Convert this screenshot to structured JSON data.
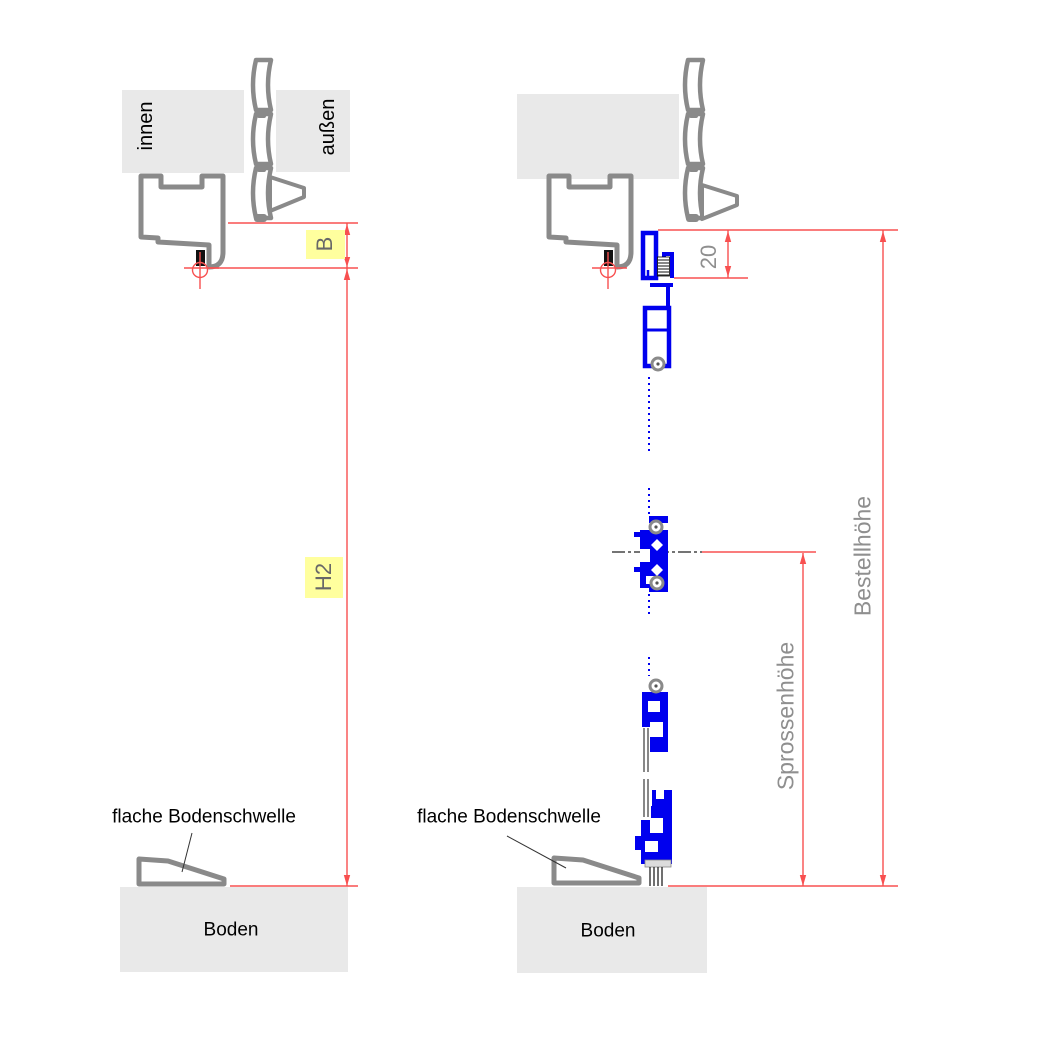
{
  "colors": {
    "profile_gray": "#8a8a8a",
    "fill_light_gray": "#e9e9e9",
    "profile_blue": "#0000ee",
    "dimension_red": "#f85050",
    "highlight_yellow": "#ffff9e",
    "dimension_text_gray": "#8f8f8f",
    "frame_dim_text_gray": "#686868",
    "label_black": "#000000"
  },
  "left_view": {
    "inside_label": "innen",
    "outside_label": "außen",
    "frame_width_dim": "B",
    "frame_height_dim": "H2",
    "threshold_label": "flache Bodenschwelle",
    "floor_label": "Boden"
  },
  "right_view": {
    "head_offset_dim": "20",
    "order_height_dim": "Bestellhöhe",
    "rung_height_dim": "Sprossenhöhe",
    "threshold_label": "flache Bodenschwelle",
    "floor_label": "Boden"
  }
}
